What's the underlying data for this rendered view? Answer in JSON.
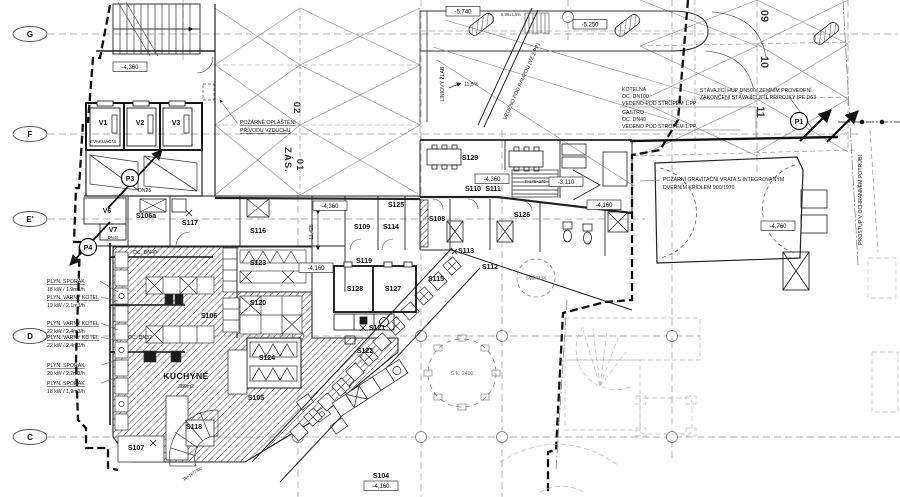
{
  "grid": {
    "rows": [
      "G",
      "F",
      "E'",
      "D",
      "C"
    ],
    "cols": [
      "09",
      "10",
      "11"
    ],
    "zone1": "ZÁS.",
    "zone1b": "01",
    "zone2": "02"
  },
  "rooms": {
    "v1": "V1",
    "v2": "V2",
    "v3": "V3",
    "v6": "V6",
    "v7": "V7",
    "evak": "EVAKUAČNÍ",
    "s104": "S104",
    "s105": "S105",
    "s106": "S106",
    "s106a": "S106a",
    "s107": "S107",
    "s108": "S108",
    "s109": "S109",
    "s110": "S110",
    "s111": "S111",
    "s112": "S112",
    "s113": "S113",
    "s114": "S114",
    "s115": "S115",
    "s116": "S116",
    "s117": "S117",
    "s118": "S118",
    "s119": "S119",
    "s120": "S120",
    "s121": "S121",
    "s122": "S122",
    "s123": "S123",
    "s124": "S124",
    "s125": "S125",
    "s126": "S126",
    "s127": "S127",
    "s128": "S128",
    "s129": "S129",
    "kitchen": "KUCHYNĚ",
    "kitchen_area": "380m2",
    "svetlik": "SVĚTLÍK",
    "sk2400": "S.K. 2400"
  },
  "markers": {
    "p1": "P1",
    "p3": "P3",
    "p4": "P4"
  },
  "levels": {
    "m5740": "-5,740",
    "m5250": "-5,250",
    "m4360": "-4,360",
    "m3110": "-3,110",
    "m4160": "-4,160",
    "m4760": "-4,760"
  },
  "ann": {
    "gas": [
      {
        "name": "PLYN. SPORÁK",
        "value": "18 kW / 1,9m3/h"
      },
      {
        "name": "PLYN. VARNÝ KOTEL",
        "value": "19 kW / 2,1m3/h"
      },
      {
        "name": "PLYN. VARNÝ KOTEL",
        "value": "22 kW / 2,4m3/h"
      },
      {
        "name": "PLYN. VARNÝ KOTEL",
        "value": "22 kW / 2,4m3/h"
      },
      {
        "name": "PLYN. SPORÁK",
        "value": "20 kW / 2,2m3/h"
      },
      {
        "name": "PLYN. SPORÁK",
        "value": "18 kW / 1,9m3/h"
      }
    ],
    "kotelna": [
      "KOTELNA",
      "OC. DN100",
      "VEDENO POD STROPEM 1.PP"
    ],
    "gastro": [
      "GASTRO",
      "OC. DN40",
      "VEDENO POD STROPEM 1.PP"
    ],
    "hup": [
      "STÁVAJÍCÍ HUP DN50 V ZEMNÍM PROVEDENÍ",
      "ZAKONČENÍ STÁVAJÍCÍ STL PŘÍPOJKY IPE D63"
    ],
    "prostup": "PROSTUP V OCHRANNÉM POTRUBÍ",
    "vrata": [
      "POŽÁRNÍ GRAVITAČNÍ VRATA S INTEGROVANÝM",
      "DVEŘNÍM KŘÍDLEM 900/1970"
    ],
    "oplasteni": [
      "POŽÁRNĚ OPLÁŠTĚNÍ",
      "PŘÍVODU VZDUCHU"
    ],
    "zlab": "LINIOVÝ ŽLAB",
    "rampou": "VEDENO POD RAMPOU (VZ 2.PP)",
    "slope": "11,5%",
    "ramp_slope": "6,98±1,5%",
    "dn25": "DN25",
    "dn40": "DN40",
    "oc_dn40": "OC. DN40",
    "oc_dn32": "OC. DN32",
    "dim": "11,425",
    "stair1": "7×175×270",
    "stair2": "18×167/300"
  }
}
